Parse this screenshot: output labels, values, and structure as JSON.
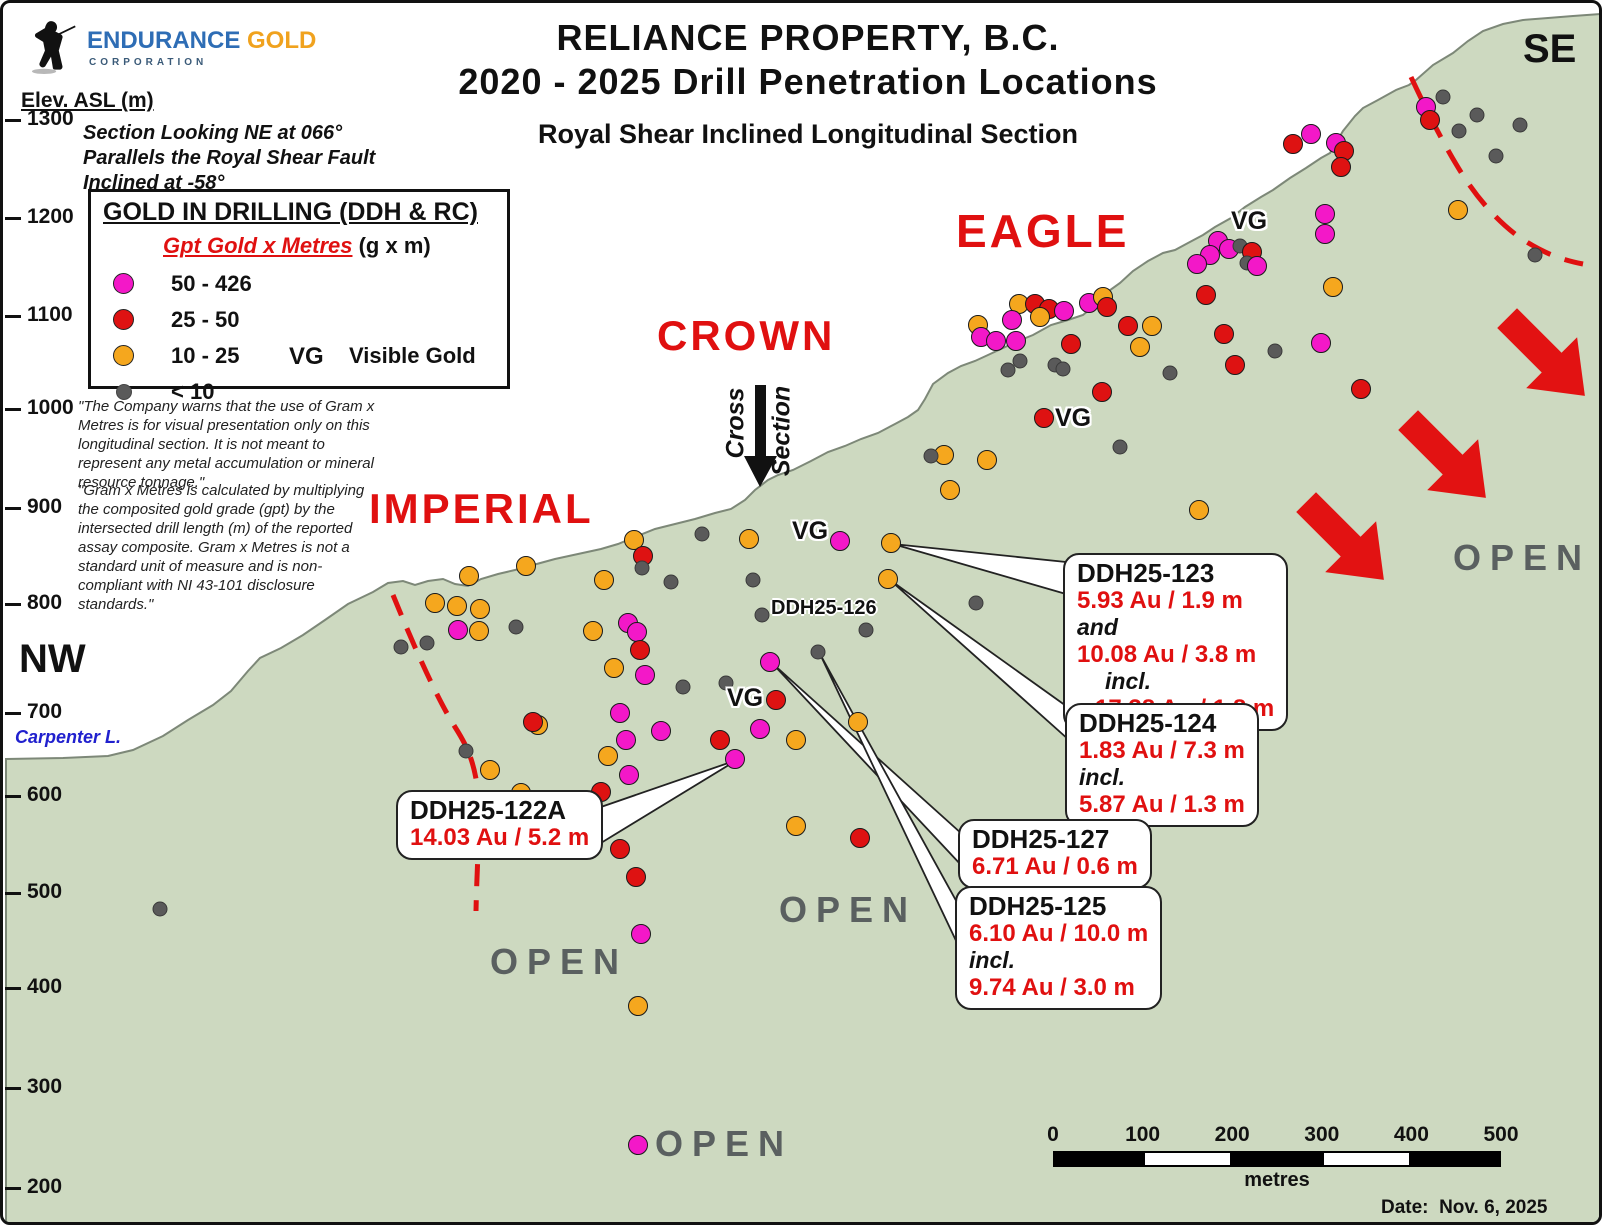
{
  "figure": {
    "title_line1": "RELIANCE PROPERTY, B.C.",
    "title_line2": "2020 - 2025 Drill Penetration Locations",
    "subtitle": "Royal Shear Inclined Longitudinal Section",
    "date_label": "Date:  Nov. 6, 2025"
  },
  "logo": {
    "name_part1": "ENDURANCE",
    "name_part2": " GOLD",
    "name_part3": "CORPORATION"
  },
  "axis": {
    "label": "Elev. ASL (m)",
    "ticks": [
      {
        "v": "1300",
        "y": 117
      },
      {
        "v": "1200",
        "y": 215
      },
      {
        "v": "1100",
        "y": 313
      },
      {
        "v": "1000",
        "y": 406
      },
      {
        "v": "900",
        "y": 505
      },
      {
        "v": "800",
        "y": 601
      },
      {
        "v": "700",
        "y": 710
      },
      {
        "v": "600",
        "y": 793
      },
      {
        "v": "500",
        "y": 890
      },
      {
        "v": "400",
        "y": 985
      },
      {
        "v": "300",
        "y": 1085
      },
      {
        "v": "200",
        "y": 1185
      }
    ]
  },
  "section_note": {
    "line1": "Section Looking NE at 066°",
    "line2": "Parallels the Royal Shear Fault",
    "line3": "Inclined at -58°"
  },
  "legend": {
    "title": "GOLD IN DRILLING (DDH & RC)",
    "subtitle_red": "Gpt Gold x Metres",
    "subtitle_units": " (g x m)",
    "items": [
      {
        "range": "50 - 426",
        "color": "#F318C8"
      },
      {
        "range": "25 - 50",
        "color": "#DE1212"
      },
      {
        "range": "10 - 25",
        "color": "#F5A71E"
      },
      {
        "range": "< 10",
        "color": "#5A5A5A"
      }
    ],
    "vg_abbr": "VG",
    "vg_label": "Visible Gold"
  },
  "disclaimers": {
    "p1": "\"The Company warns that the use of Gram x Metres is for visual presentation only on this longitudinal section. It is not meant to represent any metal accumulation or mineral resource tonnage.\"",
    "p2": "\"Gram x Metres is calculated by multiplying the composited gold grade (gpt) by the intersected drill length (m) of the reported assay composite. Gram x Metres is not a standard unit of measure and is non-compliant with NI 43-101 disclosure standards.\""
  },
  "corner_labels": {
    "nw": "NW",
    "se": "SE"
  },
  "water_label": "Carpenter L.",
  "cross_section": {
    "word1": "Cross",
    "word2": "Section"
  },
  "zone_labels": [
    {
      "text": "IMPERIAL",
      "x": 366,
      "y": 482,
      "size": 42
    },
    {
      "text": "CROWN",
      "x": 654,
      "y": 309,
      "size": 42
    },
    {
      "text": "EAGLE",
      "x": 953,
      "y": 201,
      "size": 46
    }
  ],
  "open_text": "OPEN",
  "open_labels": [
    {
      "x": 487,
      "y": 938
    },
    {
      "x": 776,
      "y": 886
    },
    {
      "x": 1450,
      "y": 534
    },
    {
      "x": 652,
      "y": 1120
    }
  ],
  "vg_text": "VG",
  "vg_labels": [
    {
      "x": 1228,
      "y": 204
    },
    {
      "x": 1052,
      "y": 401
    },
    {
      "x": 789,
      "y": 514
    },
    {
      "x": 724,
      "y": 681
    }
  ],
  "free_labels": [
    {
      "text": "DDH25-126",
      "x": 768,
      "y": 594
    }
  ],
  "callouts": [
    {
      "id": "DDH25-123",
      "x": 1060,
      "y": 550,
      "lines": [
        {
          "t": "5.93 Au / 1.9 m",
          "s": "v"
        },
        {
          "t": "and",
          "s": "j"
        },
        {
          "t": "10.08 Au / 3.8 m",
          "s": "v"
        },
        {
          "t": "incl.",
          "s": "ji"
        },
        {
          "t": "17.38 Au / 1.8 m",
          "s": "vi"
        }
      ]
    },
    {
      "id": "DDH25-124",
      "x": 1062,
      "y": 700,
      "lines": [
        {
          "t": "1.83 Au / 7.3 m",
          "s": "v"
        },
        {
          "t": "incl.",
          "s": "j"
        },
        {
          "t": "5.87 Au / 1.3 m",
          "s": "v"
        }
      ]
    },
    {
      "id": "DDH25-127",
      "x": 955,
      "y": 816,
      "lines": [
        {
          "t": "6.71 Au / 0.6 m",
          "s": "v"
        }
      ]
    },
    {
      "id": "DDH25-125",
      "x": 952,
      "y": 883,
      "lines": [
        {
          "t": "6.10 Au / 10.0 m",
          "s": "v"
        },
        {
          "t": "incl.",
          "s": "j"
        },
        {
          "t": "9.74 Au / 3.0 m",
          "s": "v"
        }
      ]
    },
    {
      "id": "DDH25-122A",
      "x": 393,
      "y": 787,
      "lines": [
        {
          "t": "14.03 Au / 5.2 m",
          "s": "v"
        }
      ]
    }
  ],
  "scalebar": {
    "x": 1050,
    "y": 1148,
    "width": 448,
    "height": 16,
    "tick_values": [
      "0",
      "100",
      "200",
      "300",
      "400",
      "500"
    ],
    "unit": "metres"
  },
  "dot_colors": {
    "m": "#F318C8",
    "r": "#DE1212",
    "o": "#F5A71E",
    "g": "#5A5A5A"
  },
  "drill_dots": [
    [
      1290,
      141,
      "r"
    ],
    [
      1308,
      131,
      "m"
    ],
    [
      1333,
      140,
      "m"
    ],
    [
      1341,
      148,
      "r"
    ],
    [
      1338,
      164,
      "r"
    ],
    [
      1423,
      104,
      "m"
    ],
    [
      1427,
      117,
      "r"
    ],
    [
      1440,
      94,
      "g"
    ],
    [
      1474,
      112,
      "g"
    ],
    [
      1456,
      128,
      "g"
    ],
    [
      1517,
      122,
      "g"
    ],
    [
      1493,
      153,
      "g"
    ],
    [
      1322,
      211,
      "m"
    ],
    [
      1322,
      231,
      "m"
    ],
    [
      1455,
      207,
      "o"
    ],
    [
      1532,
      252,
      "g"
    ],
    [
      1318,
      340,
      "m"
    ],
    [
      1272,
      348,
      "g"
    ],
    [
      1358,
      386,
      "r"
    ],
    [
      1330,
      284,
      "o"
    ],
    [
      1215,
      238,
      "m"
    ],
    [
      1226,
      246,
      "m"
    ],
    [
      1207,
      252,
      "m"
    ],
    [
      1237,
      243,
      "g"
    ],
    [
      1249,
      249,
      "r"
    ],
    [
      1244,
      260,
      "g"
    ],
    [
      1254,
      263,
      "m"
    ],
    [
      1194,
      261,
      "m"
    ],
    [
      1203,
      292,
      "r"
    ],
    [
      1221,
      331,
      "r"
    ],
    [
      1232,
      362,
      "r"
    ],
    [
      1016,
      301,
      "o"
    ],
    [
      1032,
      301,
      "r"
    ],
    [
      1046,
      306,
      "r"
    ],
    [
      1037,
      314,
      "o"
    ],
    [
      1061,
      308,
      "m"
    ],
    [
      1009,
      317,
      "m"
    ],
    [
      975,
      322,
      "o"
    ],
    [
      978,
      334,
      "m"
    ],
    [
      993,
      338,
      "m"
    ],
    [
      1013,
      338,
      "m"
    ],
    [
      1086,
      300,
      "m"
    ],
    [
      1100,
      294,
      "o"
    ],
    [
      1104,
      304,
      "r"
    ],
    [
      1125,
      323,
      "r"
    ],
    [
      1149,
      323,
      "o"
    ],
    [
      1137,
      344,
      "o"
    ],
    [
      1068,
      341,
      "r"
    ],
    [
      1017,
      358,
      "g"
    ],
    [
      1005,
      367,
      "g"
    ],
    [
      1052,
      362,
      "g"
    ],
    [
      1060,
      366,
      "g"
    ],
    [
      1167,
      370,
      "g"
    ],
    [
      1099,
      389,
      "r"
    ],
    [
      1041,
      415,
      "r"
    ],
    [
      1117,
      444,
      "g"
    ],
    [
      941,
      452,
      "o"
    ],
    [
      928,
      453,
      "g"
    ],
    [
      984,
      457,
      "o"
    ],
    [
      947,
      487,
      "o"
    ],
    [
      973,
      600,
      "g"
    ],
    [
      1196,
      507,
      "o"
    ],
    [
      631,
      537,
      "o"
    ],
    [
      640,
      553,
      "r"
    ],
    [
      639,
      565,
      "g"
    ],
    [
      699,
      531,
      "g"
    ],
    [
      746,
      536,
      "o"
    ],
    [
      837,
      538,
      "m"
    ],
    [
      888,
      540,
      "o"
    ],
    [
      885,
      576,
      "o"
    ],
    [
      601,
      577,
      "o"
    ],
    [
      668,
      579,
      "g"
    ],
    [
      750,
      577,
      "g"
    ],
    [
      759,
      612,
      "g"
    ],
    [
      863,
      627,
      "g"
    ],
    [
      815,
      649,
      "g"
    ],
    [
      767,
      659,
      "m"
    ],
    [
      723,
      680,
      "g"
    ],
    [
      680,
      684,
      "g"
    ],
    [
      773,
      697,
      "r"
    ],
    [
      757,
      726,
      "m"
    ],
    [
      717,
      737,
      "r"
    ],
    [
      732,
      756,
      "m"
    ],
    [
      855,
      719,
      "o"
    ],
    [
      793,
      737,
      "o"
    ],
    [
      793,
      823,
      "o"
    ],
    [
      857,
      835,
      "r"
    ],
    [
      523,
      563,
      "o"
    ],
    [
      466,
      573,
      "o"
    ],
    [
      432,
      600,
      "o"
    ],
    [
      454,
      603,
      "o"
    ],
    [
      477,
      606,
      "o"
    ],
    [
      455,
      627,
      "m"
    ],
    [
      476,
      628,
      "o"
    ],
    [
      513,
      624,
      "g"
    ],
    [
      398,
      644,
      "g"
    ],
    [
      424,
      640,
      "g"
    ],
    [
      590,
      628,
      "o"
    ],
    [
      625,
      620,
      "m"
    ],
    [
      634,
      629,
      "m"
    ],
    [
      637,
      647,
      "r"
    ],
    [
      611,
      665,
      "o"
    ],
    [
      642,
      672,
      "m"
    ],
    [
      617,
      710,
      "m"
    ],
    [
      658,
      728,
      "m"
    ],
    [
      623,
      737,
      "m"
    ],
    [
      605,
      753,
      "o"
    ],
    [
      626,
      772,
      "m"
    ],
    [
      598,
      789,
      "r"
    ],
    [
      535,
      722,
      "o"
    ],
    [
      530,
      719,
      "r"
    ],
    [
      463,
      748,
      "g"
    ],
    [
      487,
      767,
      "o"
    ],
    [
      518,
      790,
      "o"
    ],
    [
      617,
      846,
      "r"
    ],
    [
      633,
      874,
      "r"
    ],
    [
      638,
      931,
      "m"
    ],
    [
      635,
      1003,
      "o"
    ],
    [
      635,
      1142,
      "m"
    ],
    [
      157,
      906,
      "g"
    ]
  ]
}
